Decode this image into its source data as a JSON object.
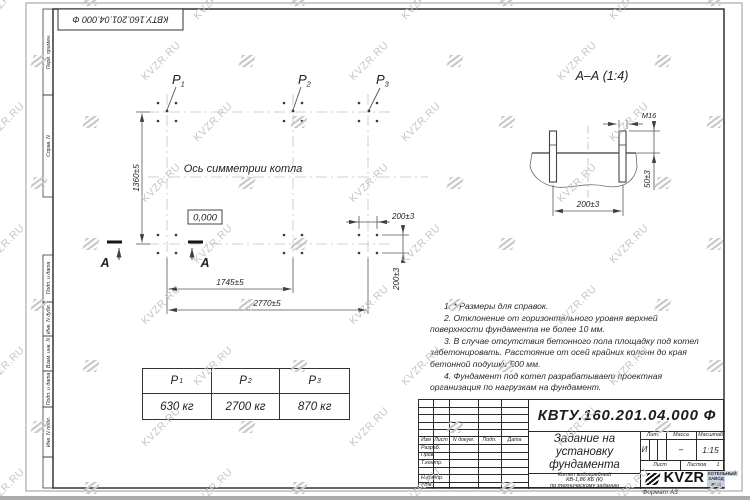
{
  "watermark": {
    "text": "KVZR.RU"
  },
  "frame": {
    "stamp_number": "КВТУ.160.201.04.000  Ф",
    "format_label": "Формат А3",
    "margin_labels": [
      "Перв. примен.",
      "Справ. N",
      "Подп. и дата",
      "Инв. N дубл.",
      "Взам. инв. N",
      "Подп. и дата",
      "Инв. N подл."
    ]
  },
  "plan": {
    "axis_label": "Ось симметрии котла",
    "elevation": "0,000",
    "section_letter": "А",
    "points": [
      {
        "label": "P",
        "sub": "1"
      },
      {
        "label": "P",
        "sub": "2"
      },
      {
        "label": "P",
        "sub": "3"
      }
    ],
    "dims": {
      "height": "1360±5",
      "mid": "1745±5",
      "full": "2770±5",
      "bolt_h": "200±3",
      "bolt_v": "200±3"
    }
  },
  "section": {
    "title": "А–А  (1:4)",
    "bolt": "М16",
    "dim_span": "200±3",
    "dim_proud": "50±3"
  },
  "notes": [
    "1. * Размеры для справок.",
    "2. Отклонение от горизонтального уровня верхней поверхности фундамента не более 10 мм.",
    "3. В случае отсутствия бетонного пола площадку под котел забетонировать. Расстояние от осей крайних колонн до края бетонной подушки 500 мм.",
    "4. Фундамент под котел разрабатывает проектная организация по нагрузкам на фундамент."
  ],
  "load_table": {
    "headers": [
      {
        "label": "P",
        "sub": "1"
      },
      {
        "label": "P",
        "sub": "2"
      },
      {
        "label": "P",
        "sub": "3"
      }
    ],
    "values": [
      "630 кг",
      "2700 кг",
      "870 кг"
    ]
  },
  "title_block": {
    "doc_number": "КВТУ.160.201.04.000  Ф",
    "title_lines": [
      "Задание на",
      "установку",
      "фундамента"
    ],
    "subject_lines": [
      "Котел водогрейный",
      "КВ-1,86 КБ (К)",
      "по техническому заданию"
    ],
    "cols": [
      "Изм",
      "Лист",
      "N докум.",
      "Подп.",
      "Дата"
    ],
    "rows": [
      "Разраб.",
      "Пров.",
      "Т.контр.",
      "",
      "Н.контр.",
      "Утв."
    ],
    "lit_label": "Лит.",
    "lit_value": "И",
    "mass_label": "Масса",
    "mass_value": "–",
    "scale_label": "Масштаб",
    "scale_value": "1:15",
    "sheet_label": "Лист",
    "sheets_label": "Листов",
    "sheets_value": "1",
    "logo_text": "KVZR",
    "logo_sub_top": "КОТЕЛЬНЫЙ",
    "logo_sub_bottom": "ЗАВОД РЭП"
  }
}
